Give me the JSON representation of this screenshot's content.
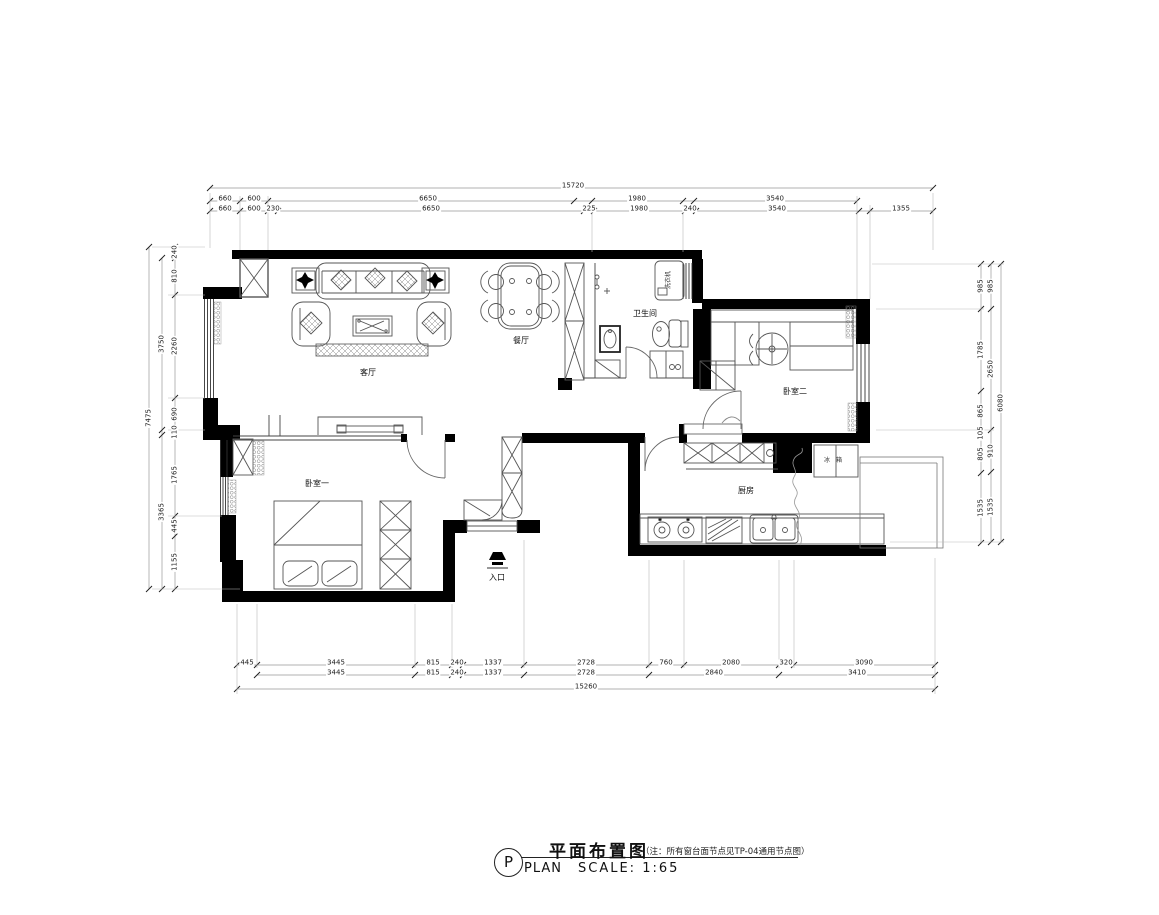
{
  "meta": {
    "background": "#ffffff",
    "wall_color": "#000000",
    "furniture_line_color": "#555555",
    "dimension_line_color": "#999999",
    "text_color": "#111111"
  },
  "title_block": {
    "symbol": "P",
    "plan_en": "PLAN",
    "title": "平面布置图",
    "note": "（注：所有窗台面节点见TP-04通用节点图）",
    "scale": "SCALE: 1:65"
  },
  "rooms": [
    {
      "name": "living-room",
      "label": "客厅",
      "x": 368,
      "y": 373
    },
    {
      "name": "dining-room",
      "label": "餐厅",
      "x": 521,
      "y": 341
    },
    {
      "name": "bathroom",
      "label": "卫生间",
      "x": 645,
      "y": 314
    },
    {
      "name": "bedroom-2",
      "label": "卧室二",
      "x": 795,
      "y": 392
    },
    {
      "name": "bedroom-1",
      "label": "卧室一",
      "x": 317,
      "y": 484
    },
    {
      "name": "kitchen",
      "label": "厨房",
      "x": 746,
      "y": 491
    },
    {
      "name": "entrance",
      "label": "入口",
      "x": 497,
      "y": 578
    }
  ],
  "fixtures": [
    {
      "name": "washing-machine",
      "label": "洗衣机",
      "x": 669,
      "y": 280,
      "rot": true
    },
    {
      "name": "fridge",
      "label": "冰箱",
      "x": 836,
      "y": 461,
      "sp": 6
    }
  ],
  "dimensions": {
    "top": [
      {
        "v": "15720",
        "x": 573,
        "y": 186
      },
      {
        "v": "660",
        "x": 225,
        "y": 199
      },
      {
        "v": "600",
        "x": 254,
        "y": 199
      },
      {
        "v": "6650",
        "x": 428,
        "y": 199
      },
      {
        "v": "1980",
        "x": 637,
        "y": 199
      },
      {
        "v": "3540",
        "x": 775,
        "y": 199
      },
      {
        "v": "660",
        "x": 225,
        "y": 209
      },
      {
        "v": "600",
        "x": 254,
        "y": 209
      },
      {
        "v": "230",
        "x": 273,
        "y": 209
      },
      {
        "v": "6650",
        "x": 431,
        "y": 209
      },
      {
        "v": "225",
        "x": 589,
        "y": 209
      },
      {
        "v": "1980",
        "x": 639,
        "y": 209
      },
      {
        "v": "240",
        "x": 690,
        "y": 209
      },
      {
        "v": "3540",
        "x": 777,
        "y": 209
      },
      {
        "v": "1355",
        "x": 901,
        "y": 209
      }
    ],
    "bottom": [
      {
        "v": "445",
        "x": 247,
        "y": 663
      },
      {
        "v": "3445",
        "x": 336,
        "y": 663
      },
      {
        "v": "815",
        "x": 433,
        "y": 663
      },
      {
        "v": "240",
        "x": 457,
        "y": 663
      },
      {
        "v": "1337",
        "x": 493,
        "y": 663
      },
      {
        "v": "2728",
        "x": 586,
        "y": 663
      },
      {
        "v": "760",
        "x": 666,
        "y": 663
      },
      {
        "v": "2080",
        "x": 731,
        "y": 663
      },
      {
        "v": "320",
        "x": 786,
        "y": 663
      },
      {
        "v": "3090",
        "x": 864,
        "y": 663
      },
      {
        "v": "3445",
        "x": 336,
        "y": 673
      },
      {
        "v": "815",
        "x": 433,
        "y": 673
      },
      {
        "v": "240",
        "x": 457,
        "y": 673
      },
      {
        "v": "1337",
        "x": 493,
        "y": 673
      },
      {
        "v": "2728",
        "x": 586,
        "y": 673
      },
      {
        "v": "2840",
        "x": 714,
        "y": 673
      },
      {
        "v": "3410",
        "x": 857,
        "y": 673
      },
      {
        "v": "15260",
        "x": 586,
        "y": 687
      }
    ],
    "left": [
      {
        "v": "240",
        "x": 175,
        "y": 252
      },
      {
        "v": "810",
        "x": 175,
        "y": 276
      },
      {
        "v": "2260",
        "x": 175,
        "y": 346
      },
      {
        "v": "690",
        "x": 175,
        "y": 414
      },
      {
        "v": "110",
        "x": 175,
        "y": 432
      },
      {
        "v": "1765",
        "x": 175,
        "y": 475
      },
      {
        "v": "445",
        "x": 175,
        "y": 526
      },
      {
        "v": "1155",
        "x": 175,
        "y": 562
      },
      {
        "v": "3750",
        "x": 162,
        "y": 344
      },
      {
        "v": "3365",
        "x": 162,
        "y": 512
      },
      {
        "v": "7475",
        "x": 149,
        "y": 418
      }
    ],
    "right": [
      {
        "v": "985",
        "x": 981,
        "y": 286
      },
      {
        "v": "1785",
        "x": 981,
        "y": 350
      },
      {
        "v": "865",
        "x": 981,
        "y": 411
      },
      {
        "v": "105",
        "x": 981,
        "y": 433
      },
      {
        "v": "805",
        "x": 981,
        "y": 454
      },
      {
        "v": "1535",
        "x": 981,
        "y": 508
      },
      {
        "v": "985",
        "x": 991,
        "y": 286
      },
      {
        "v": "2650",
        "x": 991,
        "y": 369
      },
      {
        "v": "910",
        "x": 991,
        "y": 451
      },
      {
        "v": "1535",
        "x": 991,
        "y": 507
      },
      {
        "v": "6080",
        "x": 1001,
        "y": 403
      }
    ]
  }
}
